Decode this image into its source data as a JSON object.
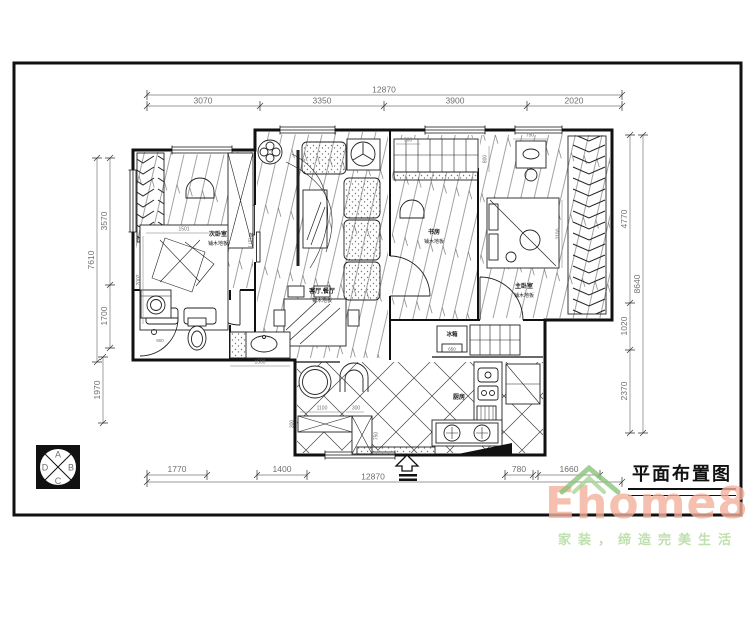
{
  "drawing": {
    "title": "平面布置图"
  },
  "dims": {
    "top": {
      "overall": "12870",
      "seg1": "3070",
      "seg2": "3350",
      "seg3": "3900",
      "seg4": "2020"
    },
    "left": {
      "overall": "7610",
      "seg1": "3570",
      "seg2": "1700",
      "seg3": "1970"
    },
    "right": {
      "overall": "8640",
      "seg1": "4770",
      "seg2": "1020",
      "seg3": "2370"
    },
    "bottom": {
      "overall": "12870",
      "seg1": "1770",
      "seg2": "1400",
      "seg3": "780",
      "seg4": "1660"
    }
  },
  "inner_dims": {
    "bed_w": "1501",
    "bed_h": "2002",
    "cab": "500",
    "dresser": "750",
    "study_side": "800",
    "bed_side": "1100",
    "shower": "900",
    "vanity": "1500",
    "fridge_size": "650",
    "counter_w": "1100",
    "counter_s": "300",
    "counter_d": "300",
    "cab_h": "750"
  },
  "rooms": {
    "bedroom2": {
      "name": "次卧室",
      "floor": "铺木地板"
    },
    "living": {
      "name": "客厅,餐厅",
      "floor": "铺木地板"
    },
    "study": {
      "name": "书房",
      "floor": "铺木地板"
    },
    "master": {
      "name": "主卧室",
      "floor": "铺木地板"
    },
    "kitchen": {
      "name": "厨房"
    }
  },
  "labels": {
    "fridge": "冰箱",
    "sliding_door": "推拉门"
  },
  "compass": {
    "a": "A",
    "b": "B",
    "c": "C",
    "d": "D"
  },
  "watermark": {
    "brand": "Ehome8",
    "slogan": "家装，缔造完美生活"
  },
  "colors": {
    "line": "#1b1b1b",
    "dim_text": "#6f6f6f",
    "brand": "#f3b09b",
    "slogan": "#bfe0ad",
    "roof": "#8cc47a"
  }
}
